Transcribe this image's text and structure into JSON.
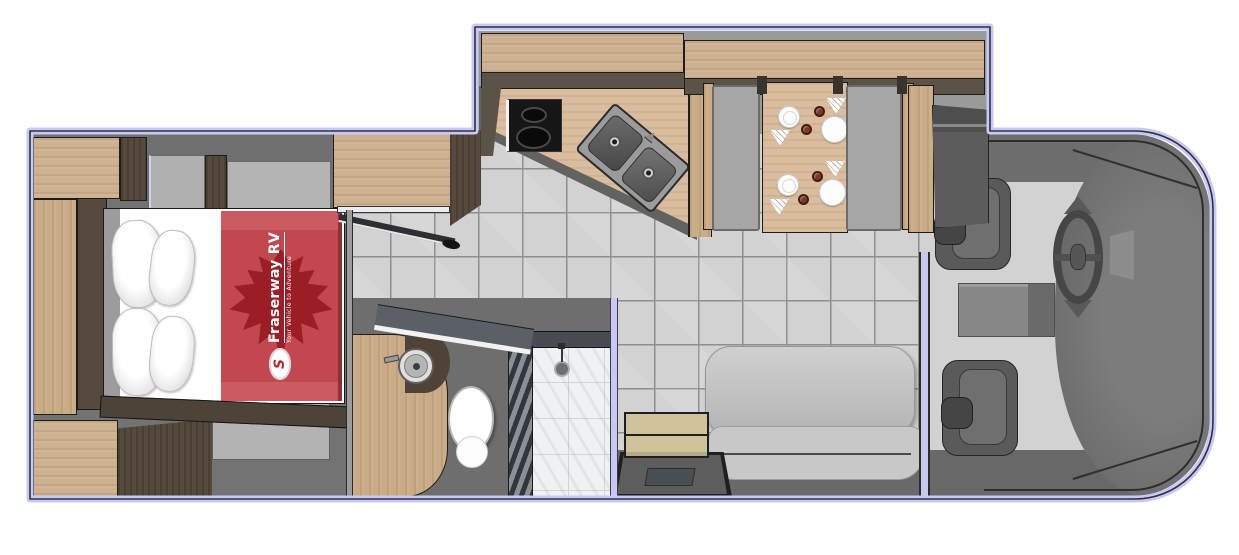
{
  "plan": {
    "type": "rv-motorhome-floorplan",
    "logo": {
      "brand": "Fraserway RV",
      "tagline": "Your Vehicle to Adventure",
      "badge_glyph": "S"
    },
    "colors": {
      "outline_lavender": "#c9c9f0",
      "outline_dark": "#2e2e4a",
      "wood_light": "#cdb190",
      "wood_counter": "#d9bd9e",
      "wood_dark": "#564a3d",
      "floor_dark": "#6f6f6f",
      "floor_tile": "#d2d2d2",
      "bench_gray": "#a6a6a6",
      "sofa_gray": "#c6c6c6",
      "blanket_red": "#c24850",
      "maple_leaf_red": "#9b1e27",
      "step_tan": "#cfc39b",
      "cab_floor_gray": "#d2d2d2",
      "cab_dark_gray": "#6d6d6d",
      "seat_dark": "#5a5a5a",
      "shower_marble": "#f0f1f3"
    }
  }
}
